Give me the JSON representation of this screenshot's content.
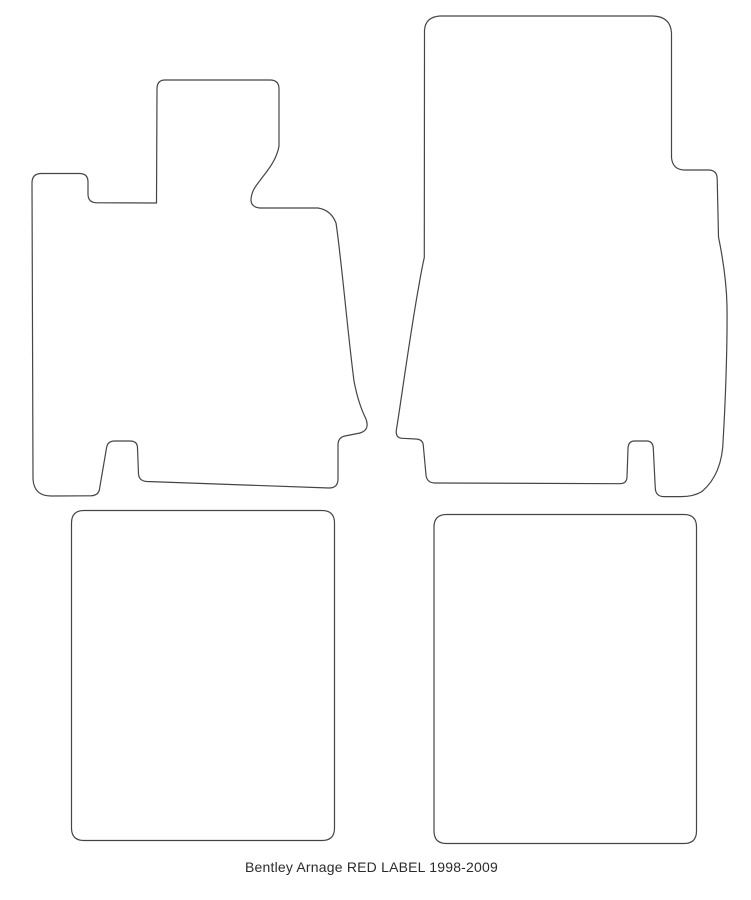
{
  "page": {
    "caption": "Bentley Arnage RED LABEL 1998-2009"
  },
  "colors": {
    "background": "#ffffff",
    "outline": "#454545",
    "caption_text": "#2b2b2b"
  },
  "diagram": {
    "type": "car-floor-mat-set-template",
    "mats": [
      {
        "id": "front-left-mat",
        "path": "M 165 80 L 270 80 Q 279 80 279 89 L 279 146 C 276 164 262 176 254 189 C 252 193 251 197 251 200 Q 251 207 260 208 L 318 208 Q 331 210 336 223 C 341 255 348 336 354 381 C 357 397 361 409 366 419 Q 370 430 360 433 L 345 436 Q 338 437.5 338 445 L 338 479 Q 338 488 329 488 L 147 481.5 Q 139 481 138.5 474 L 137.5 448 Q 137.5 441 130 441 L 114.5 441 Q 107.5 441 106.5 448 L 99.5 489 Q 98.5 495.8 90 495.8 L 51 496 Q 34 496 33 479 L 32 183 Q 32 173.5 41.5 173.5 L 79.5 173.5 Q 88 173.5 88 182 L 88 194 Q 88 202.5 96.5 202.8 L 156.5 203 L 157 89 Q 157 80 165 80 Z"
      },
      {
        "id": "front-right-mat",
        "path": "M 440 16 L 653 16 Q 670.5 16.5 671.5 33 L 671.5 157.5 Q 672.5 169.5 684 170 L 708.5 170 Q 717 170 717.2 179 L 718.5 237 C 723 259 726.5 281 727 306 C 727.5 350 725 409 723.2 439 Q 722.5 474 702 491.5 Q 693.5 496.8 680 496.6 L 663.5 496.6 Q 655.8 496.3 655.3 488.5 L 653.3 448.5 Q 653 441 646.5 441 L 634.5 441 Q 628.3 441 628 448.5 L 627 477 Q 626.8 483.8 619.5 483.7 L 434.8 483 Q 426.8 482.8 426 475 L 423.3 445.5 Q 423 439.2 415.5 439 L 402.5 438.3 Q 395.5 438 396.3 430.5 C 400.5 405 411 328 419 285 Q 421.8 268.5 424.3 257.5 L 424.5 30 Q 425.5 17 440 16 Z"
      },
      {
        "id": "rear-left-mat",
        "path": "M 84 510.5 L 322 510.5 Q 334.5 510.5 334.5 523 L 334.5 828 Q 334.5 840.5 322 840.5 L 84 840.5 Q 71.5 840.5 71.5 828 L 71.5 523 Q 71.5 510.5 84 510.5 Z"
      },
      {
        "id": "rear-right-mat",
        "path": "M 446.5 514.5 L 684 514.5 Q 696.5 514.5 696.5 527 L 696.5 831 Q 696.5 843.5 684 843.5 L 446.5 843.5 Q 434 843.5 434 831 L 434 527 Q 434 514.5 446.5 514.5 Z"
      }
    ]
  }
}
